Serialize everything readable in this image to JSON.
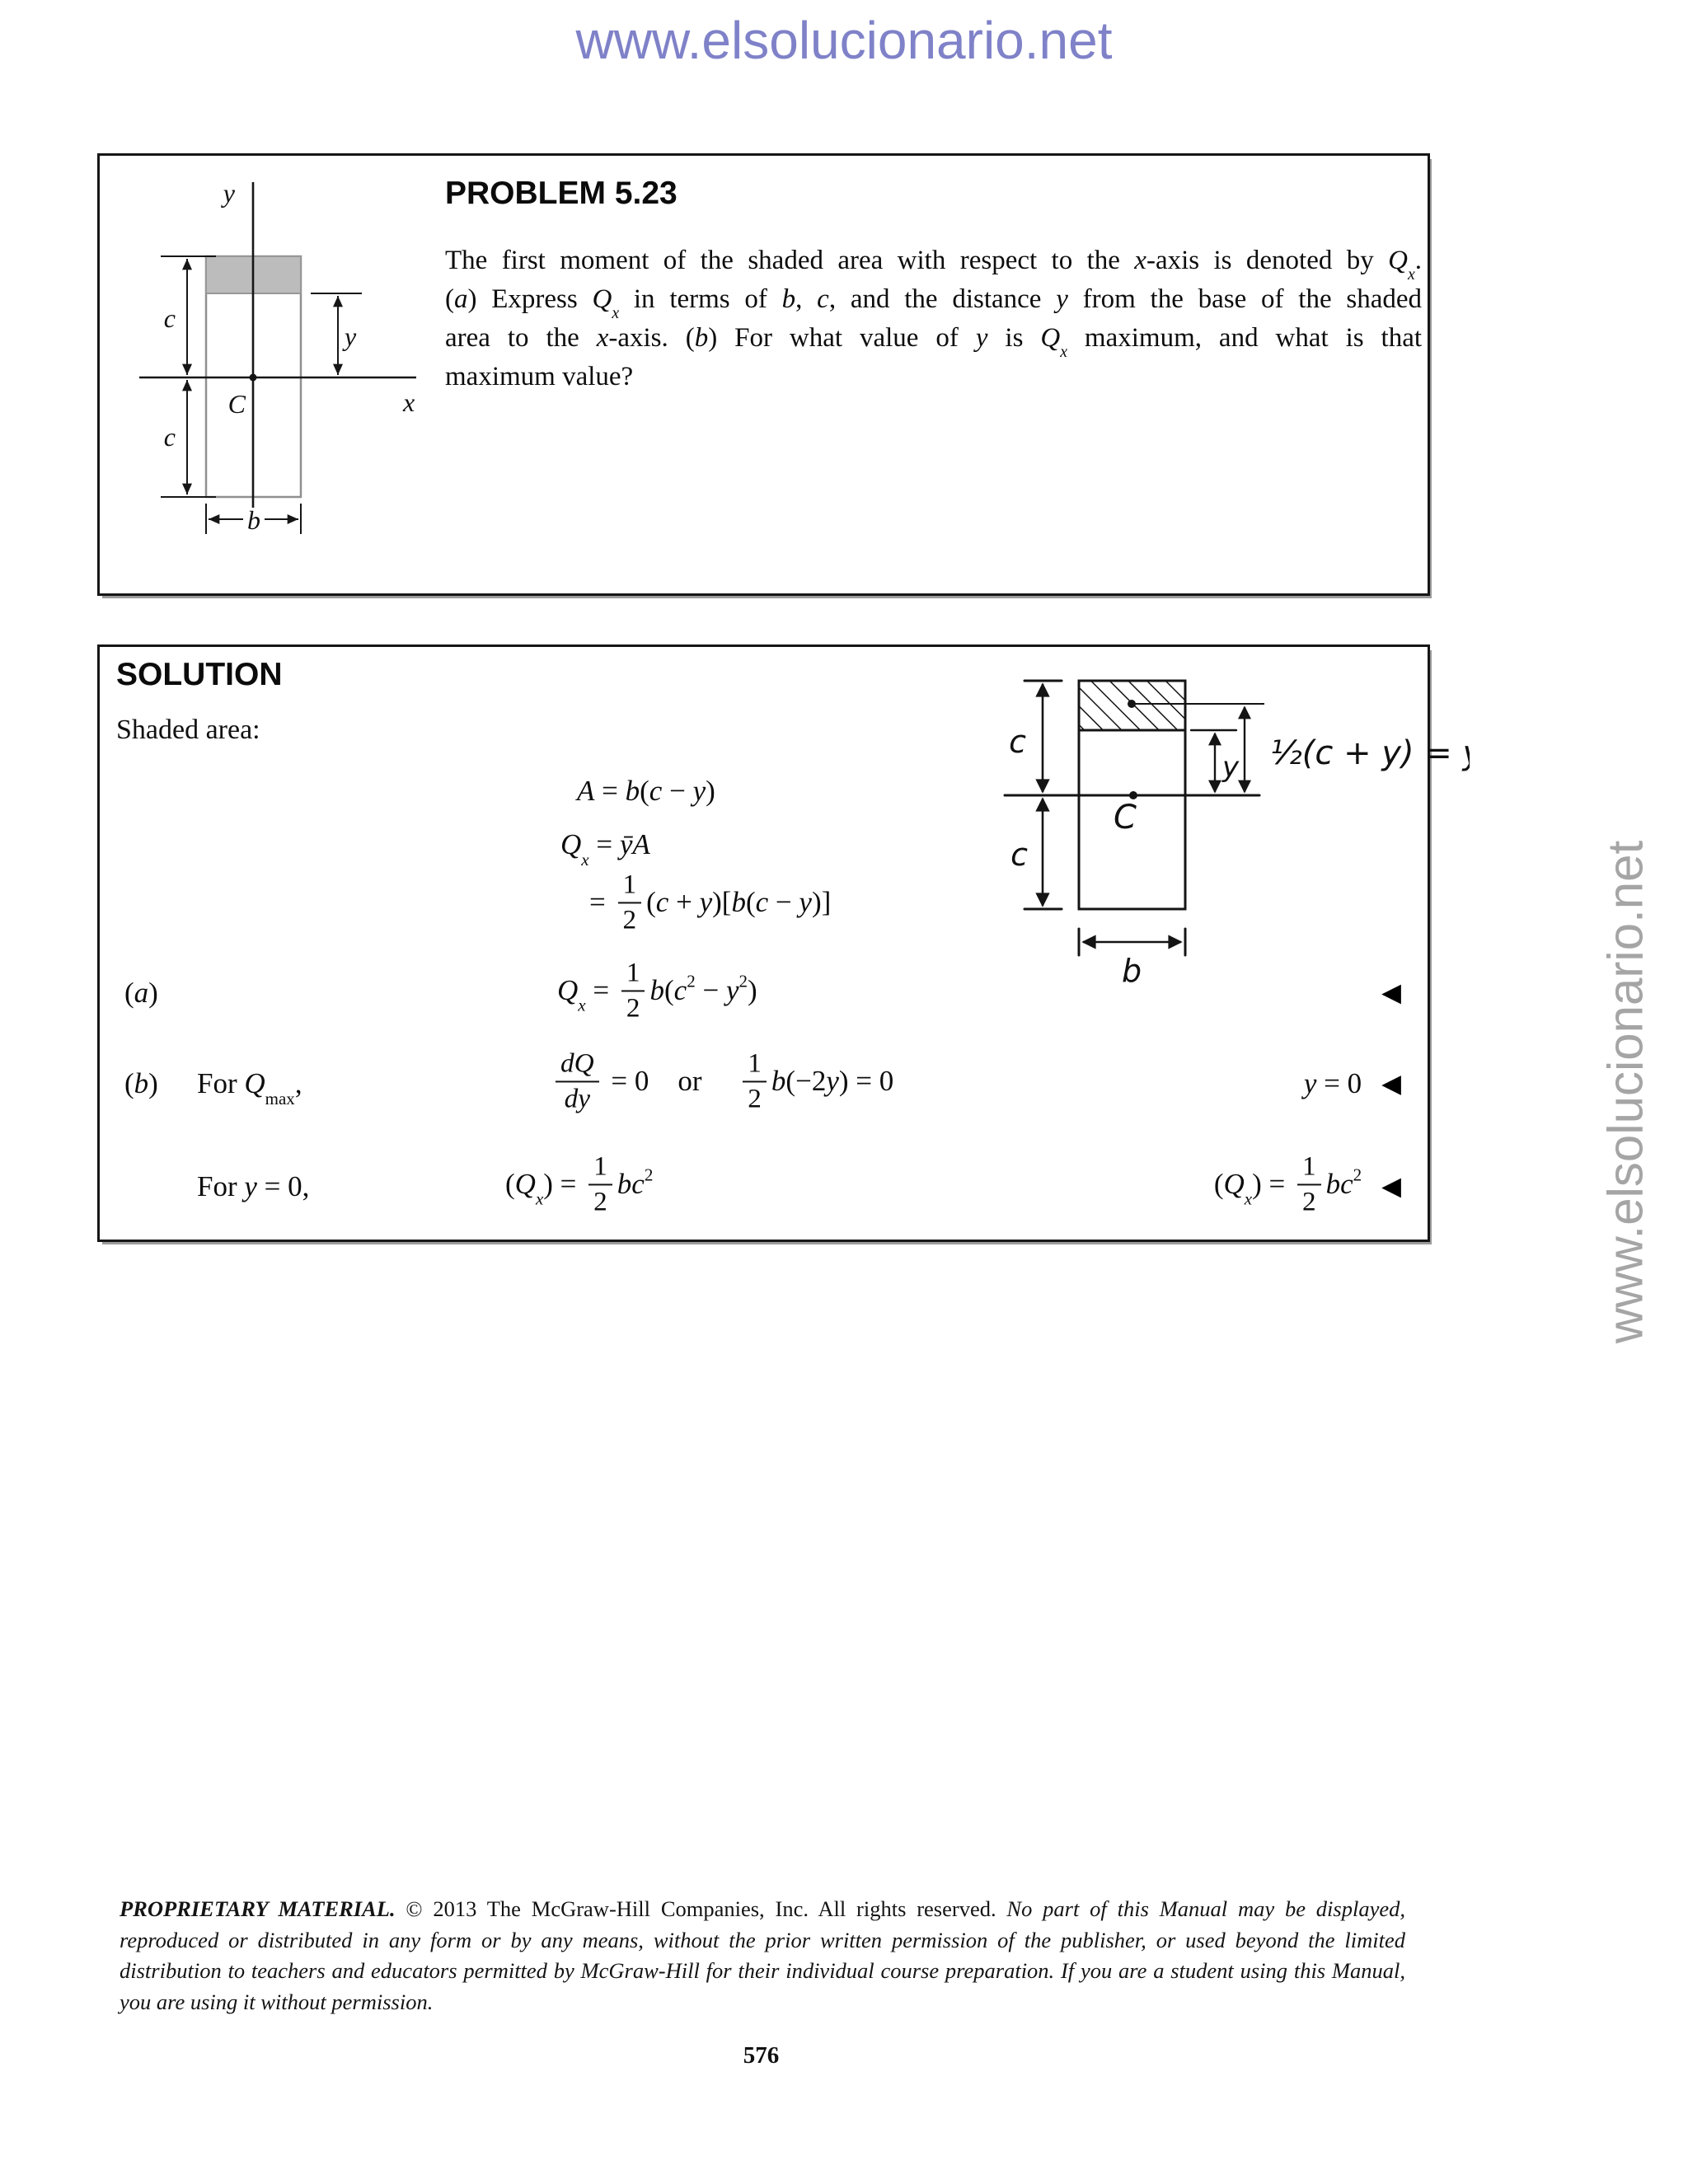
{
  "header": {
    "url": "www.elsolucionario.net"
  },
  "watermark": {
    "url": "www.elsolucionario.net"
  },
  "page": {
    "number": "576"
  },
  "problem": {
    "title": "PROBLEM 5.23",
    "body_lines": [
      [
        {
          "k": "r",
          "t": "The first moment of the shaded area with respect to the "
        },
        {
          "k": "i",
          "t": "x"
        },
        {
          "k": "r",
          "t": "-axis is denoted by "
        },
        {
          "k": "i",
          "t": "Q"
        },
        {
          "k": "subi",
          "t": "x"
        },
        {
          "k": "r",
          "t": "."
        }
      ],
      [
        {
          "k": "r",
          "t": "("
        },
        {
          "k": "i",
          "t": "a"
        },
        {
          "k": "r",
          "t": ") Express "
        },
        {
          "k": "i",
          "t": "Q"
        },
        {
          "k": "subi",
          "t": "x"
        },
        {
          "k": "r",
          "t": " in terms of "
        },
        {
          "k": "i",
          "t": "b"
        },
        {
          "k": "r",
          "t": ", "
        },
        {
          "k": "i",
          "t": "c"
        },
        {
          "k": "r",
          "t": ", and the distance "
        },
        {
          "k": "i",
          "t": "y"
        },
        {
          "k": "r",
          "t": " from the base of the shaded"
        }
      ],
      [
        {
          "k": "r",
          "t": "area to the "
        },
        {
          "k": "i",
          "t": "x"
        },
        {
          "k": "r",
          "t": "-axis. ("
        },
        {
          "k": "i",
          "t": "b"
        },
        {
          "k": "r",
          "t": ") For what value of "
        },
        {
          "k": "i",
          "t": "y"
        },
        {
          "k": "r",
          "t": " is "
        },
        {
          "k": "i",
          "t": "Q"
        },
        {
          "k": "subi",
          "t": "x"
        },
        {
          "k": "r",
          "t": " maximum, and what is that"
        }
      ],
      [
        {
          "k": "r",
          "t": "maximum value?"
        }
      ]
    ],
    "figure": {
      "labels": {
        "axis_y": "y",
        "axis_x": "x",
        "centroid": "C",
        "c_top": "c",
        "c_bottom": "c",
        "dim_y": "y",
        "dim_b": "b"
      }
    }
  },
  "solution": {
    "heading": "SOLUTION",
    "shaded_label": "Shaded area:",
    "marker": "◀",
    "eq_area": [
      {
        "k": "i",
        "t": "A"
      },
      {
        "k": "r",
        "t": " = "
      },
      {
        "k": "i",
        "t": "b"
      },
      {
        "k": "r",
        "t": "("
      },
      {
        "k": "i",
        "t": "c"
      },
      {
        "k": "r",
        "t": " − "
      },
      {
        "k": "i",
        "t": "y"
      },
      {
        "k": "r",
        "t": ")"
      }
    ],
    "eq_qx": [
      {
        "k": "i",
        "t": "Q"
      },
      {
        "k": "subi",
        "t": "x"
      },
      {
        "k": "r",
        "t": " = "
      },
      {
        "k": "i",
        "t": "ȳA"
      }
    ],
    "eq_qx_expanded": [
      {
        "k": "r",
        "t": "= "
      },
      {
        "k": "frac",
        "n": "1",
        "d": "2"
      },
      {
        "k": "r",
        "t": "("
      },
      {
        "k": "i",
        "t": "c"
      },
      {
        "k": "r",
        "t": " + "
      },
      {
        "k": "i",
        "t": "y"
      },
      {
        "k": "r",
        "t": ")["
      },
      {
        "k": "i",
        "t": "b"
      },
      {
        "k": "r",
        "t": "("
      },
      {
        "k": "i",
        "t": "c"
      },
      {
        "k": "r",
        "t": " − "
      },
      {
        "k": "i",
        "t": "y"
      },
      {
        "k": "r",
        "t": ")]"
      }
    ],
    "part_a": {
      "label": [
        {
          "k": "r",
          "t": "("
        },
        {
          "k": "i",
          "t": "a"
        },
        {
          "k": "r",
          "t": ")"
        }
      ],
      "equation": [
        {
          "k": "i",
          "t": "Q"
        },
        {
          "k": "subi",
          "t": "x"
        },
        {
          "k": "r",
          "t": " = "
        },
        {
          "k": "frac",
          "n": "1",
          "d": "2"
        },
        {
          "k": "i",
          "t": "b"
        },
        {
          "k": "r",
          "t": "("
        },
        {
          "k": "i",
          "t": "c"
        },
        {
          "k": "sup",
          "t": "2"
        },
        {
          "k": "r",
          "t": " − "
        },
        {
          "k": "i",
          "t": "y"
        },
        {
          "k": "sup",
          "t": "2"
        },
        {
          "k": "r",
          "t": ")"
        }
      ]
    },
    "part_b": {
      "label": [
        {
          "k": "r",
          "t": "("
        },
        {
          "k": "i",
          "t": "b"
        },
        {
          "k": "r",
          "t": ")"
        }
      ],
      "condition": [
        {
          "k": "r",
          "t": "For "
        },
        {
          "k": "i",
          "t": "Q"
        },
        {
          "k": "sub",
          "t": "max"
        },
        {
          "k": "r",
          "t": ","
        }
      ],
      "equation": [
        {
          "k": "frac",
          "n": "dQ",
          "d": "dy",
          "it": true
        },
        {
          "k": "r",
          "t": " = 0 or  "
        },
        {
          "k": "frac",
          "n": "1",
          "d": "2"
        },
        {
          "k": "i",
          "t": "b"
        },
        {
          "k": "r",
          "t": "(−2"
        },
        {
          "k": "i",
          "t": "y"
        },
        {
          "k": "r",
          "t": ") = 0"
        }
      ],
      "answer": [
        {
          "k": "i",
          "t": "y"
        },
        {
          "k": "r",
          "t": " = 0"
        }
      ]
    },
    "part_b2": {
      "condition": [
        {
          "k": "r",
          "t": "For "
        },
        {
          "k": "i",
          "t": "y"
        },
        {
          "k": "r",
          "t": " = 0,"
        }
      ],
      "equation": [
        {
          "k": "r",
          "t": "("
        },
        {
          "k": "i",
          "t": "Q"
        },
        {
          "k": "subi",
          "t": "x"
        },
        {
          "k": "r",
          "t": ") = "
        },
        {
          "k": "frac",
          "n": "1",
          "d": "2"
        },
        {
          "k": "i",
          "t": "bc"
        },
        {
          "k": "sup",
          "t": "2"
        }
      ],
      "answer": [
        {
          "k": "r",
          "t": "("
        },
        {
          "k": "i",
          "t": "Q"
        },
        {
          "k": "subi",
          "t": "x"
        },
        {
          "k": "r",
          "t": ") = "
        },
        {
          "k": "frac",
          "n": "1",
          "d": "2"
        },
        {
          "k": "i",
          "t": "bc"
        },
        {
          "k": "sup",
          "t": "2"
        }
      ]
    },
    "figure": {
      "labels": {
        "c_top": "c",
        "c_bottom": "c",
        "centroid": "C",
        "dim_y": "y",
        "dim_b": "b",
        "ybar_note": "½(c + y) = ȳ"
      }
    }
  },
  "footer": {
    "lines": [
      [
        {
          "k": "bi",
          "t": "PROPRIETARY MATERIAL."
        },
        {
          "k": "r",
          "t": " © 2013 The McGraw-Hill Companies, Inc. All rights reserved. "
        },
        {
          "k": "i",
          "t": "No part of this Manual may be displayed,"
        }
      ],
      [
        {
          "k": "i",
          "t": "reproduced or distributed in any form or by any means, without the prior written permission of the publisher, or used beyond the limited"
        }
      ],
      [
        {
          "k": "i",
          "t": "distribution to teachers and educators permitted by McGraw-Hill for their individual course preparation. If you are a student using this Manual,"
        }
      ],
      [
        {
          "k": "i",
          "t": "you are using it without permission."
        }
      ]
    ]
  }
}
